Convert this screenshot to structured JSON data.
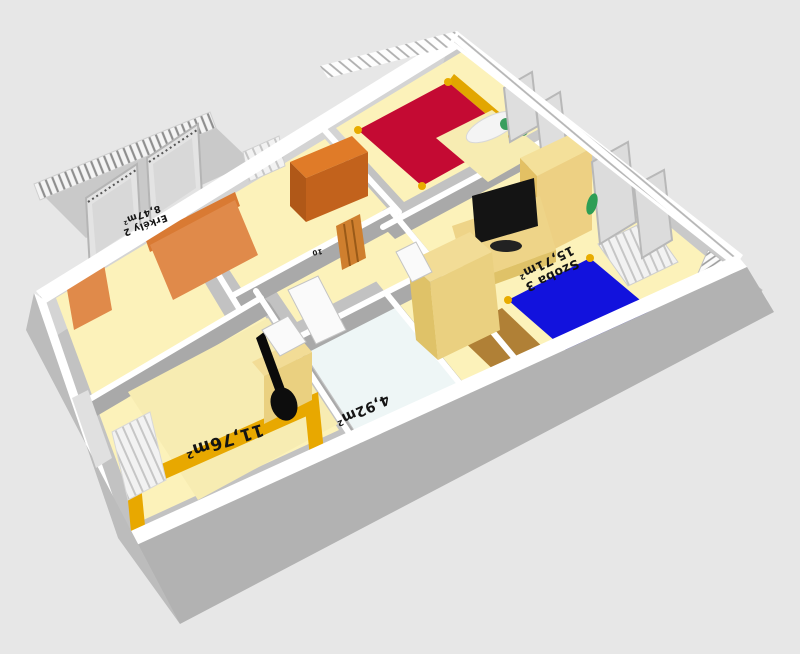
{
  "scene": {
    "labels": {
      "balcony": {
        "name": "Erkély 2",
        "area": "8,47m²"
      },
      "bedroom": {
        "area": "11,76m²"
      },
      "bathroom": {
        "area": "4,92m²"
      },
      "room3": {
        "name": "Szoba 3",
        "area": "15,71m²"
      },
      "hall": {
        "partial_text": "10"
      }
    },
    "colors": {
      "background": "#e7e7e7",
      "wall_top": "#ffffff",
      "wall_outer": "#b2b2b2",
      "wall_inner": "#d2d2d2",
      "floor": "#fcf2ba",
      "floor_bathroom": "#eef6f6",
      "floor_wood": "#b08036",
      "bed_red": "#c40a33",
      "bed_blue": "#1212dd",
      "bed_frame_gold": "#e8ac00",
      "bedding_cream": "#f7ecb2",
      "sofa_orange": "#e08a4a",
      "cabinet_orange": "#cf7220",
      "wardrobe_beige": "#f2dc96",
      "tv_black": "#141414",
      "guitar_black": "#0a0a0a",
      "radiator_white": "#f0f0f0",
      "plant_green": "#3a9e5e",
      "label_text": "#141414"
    }
  }
}
